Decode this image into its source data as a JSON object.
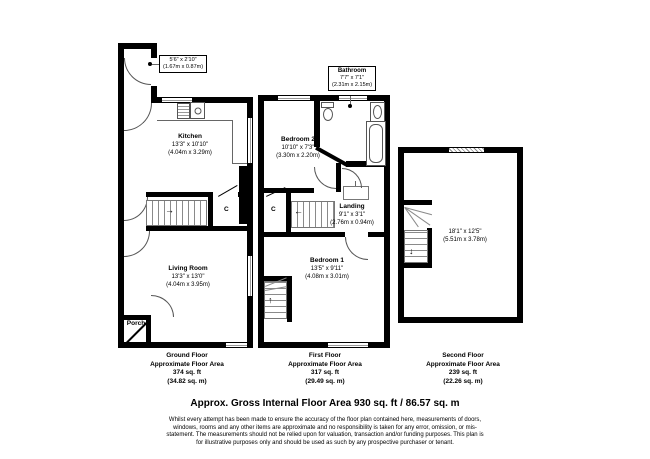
{
  "document": {
    "title": "Approx. Gross Internal Floor Area 930 sq. ft / 86.57 sq. m",
    "disclaimer": "Whilst every attempt has been made to ensure the accuracy of the floor plan contained here, measurements of doors, windows, rooms and any other items are approximate and no responsibility is taken for any error, omission, or mis-statement. The measurements should not be relied upon for valuation, transaction and/or funding purposes. This plan is for illustrative purposes only and should be used as such by any prospective purchaser or tenant."
  },
  "floors": {
    "ground": {
      "name": "Ground Floor",
      "area_label": "Approximate Floor Area",
      "area_imperial": "374 sq. ft",
      "area_metric": "(34.82 sq. m)"
    },
    "first": {
      "name": "First Floor",
      "area_label": "Approximate Floor Area",
      "area_imperial": "317 sq. ft",
      "area_metric": "(29.49 sq. m)"
    },
    "second": {
      "name": "Second Floor",
      "area_label": "Approximate Floor Area",
      "area_imperial": "239 sq. ft",
      "area_metric": "(22.26 sq. m)"
    }
  },
  "rooms": {
    "entry": {
      "imperial": "5'6\" x 2'10\"",
      "metric": "(1.67m x 0.87m)"
    },
    "kitchen": {
      "name": "Kitchen",
      "imperial": "13'3\" x 10'10\"",
      "metric": "(4.04m x 3.29m)"
    },
    "living_room": {
      "name": "Living Room",
      "imperial": "13'3\" x 13'0\"",
      "metric": "(4.04m x 3.95m)"
    },
    "porch": {
      "name": "Porch"
    },
    "bathroom": {
      "name": "Bathroom",
      "imperial": "7'7\" x 7'1\"",
      "metric": "(2.31m x 2.15m)"
    },
    "bedroom2": {
      "name": "Bedroom 2",
      "imperial": "10'10\" x 7'3\"",
      "metric": "(3.30m x 2.20m)"
    },
    "landing": {
      "name": "Landing",
      "imperial": "9'1\" x 3'1\"",
      "metric": "(2.76m x 0.94m)"
    },
    "bedroom1": {
      "name": "Bedroom 1",
      "imperial": "13'5\" x 9'11\"",
      "metric": "(4.08m x 3.01m)"
    },
    "second_floor_room": {
      "imperial": "18'1\" x 12'5\"",
      "metric": "(5.51m x 3.78m)"
    }
  },
  "cupboard_label": "C",
  "icons": {
    "stairs_up_arrow": "↑",
    "stairs_down_arrow": "↓",
    "stairs_right_arrow": "→",
    "stairs_left_arrow": "←"
  },
  "colors": {
    "wall": "#000000",
    "background": "#ffffff",
    "thin_line": "#555555"
  }
}
